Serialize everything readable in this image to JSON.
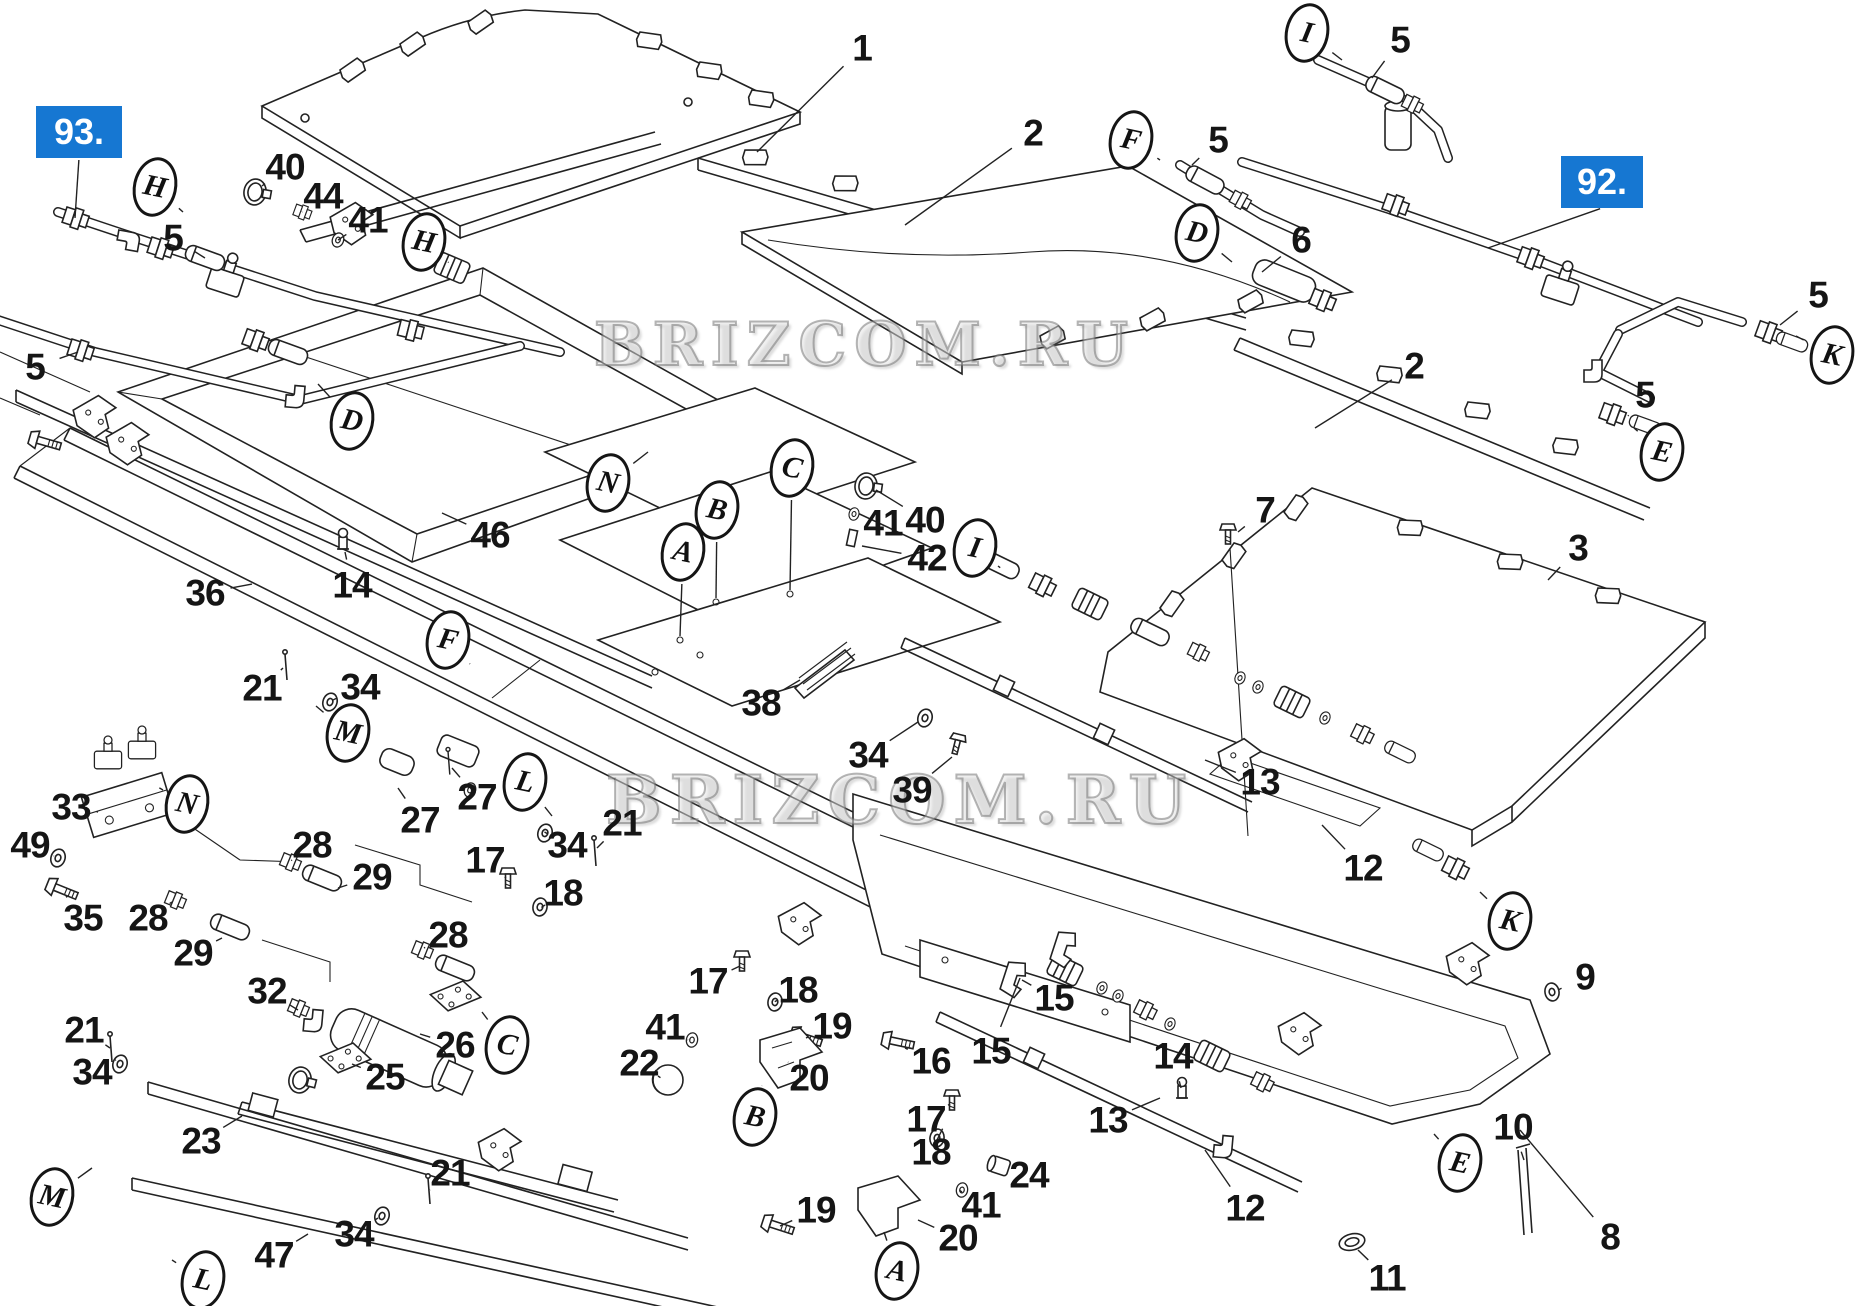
{
  "accent_color": "#1677d2",
  "watermark": {
    "text": "BRIZCOM.RU"
  },
  "watermarks": [
    {
      "x": 865,
      "y": 345,
      "size": 60
    },
    {
      "x": 900,
      "y": 800,
      "size": 66
    }
  ],
  "highlight_boxes": [
    {
      "label": "93.",
      "x": 36,
      "y": 106,
      "w": 86,
      "h": 52,
      "leader": [
        75,
        218
      ]
    },
    {
      "label": "92.",
      "x": 1561,
      "y": 156,
      "w": 82,
      "h": 52,
      "leader": [
        1488,
        248
      ]
    }
  ],
  "callouts": {
    "numbers": [
      {
        "t": "1",
        "x": 862,
        "y": 48,
        "l": [
          757,
          152
        ]
      },
      {
        "t": "2",
        "x": 1033,
        "y": 133,
        "l": [
          905,
          225
        ]
      },
      {
        "t": "2",
        "x": 1414,
        "y": 366,
        "l": [
          1315,
          428
        ]
      },
      {
        "t": "3",
        "x": 1578,
        "y": 548,
        "l": [
          1548,
          580
        ]
      },
      {
        "t": "5",
        "x": 173,
        "y": 238,
        "l": [
          205,
          258
        ]
      },
      {
        "t": "5",
        "x": 35,
        "y": 367,
        "l": [
          78,
          352
        ]
      },
      {
        "t": "5",
        "x": 1218,
        "y": 140,
        "l": [
          1192,
          165
        ]
      },
      {
        "t": "5",
        "x": 1400,
        "y": 40,
        "l": [
          1372,
          78
        ]
      },
      {
        "t": "5",
        "x": 1818,
        "y": 295,
        "l": [
          1780,
          325
        ]
      },
      {
        "t": "5",
        "x": 1645,
        "y": 395,
        "l": [
          1628,
          416
        ]
      },
      {
        "t": "6",
        "x": 1301,
        "y": 240,
        "l": [
          1262,
          272
        ]
      },
      {
        "t": "7",
        "x": 1265,
        "y": 510,
        "l": [
          1238,
          532
        ]
      },
      {
        "t": "8",
        "x": 1610,
        "y": 1237,
        "l": [
          1520,
          1130
        ]
      },
      {
        "t": "9",
        "x": 1585,
        "y": 977,
        "l": [
          1558,
          990
        ]
      },
      {
        "t": "10",
        "x": 1513,
        "y": 1127,
        "l": [
          1524,
          1160
        ]
      },
      {
        "t": "11",
        "x": 1387,
        "y": 1278,
        "l": [
          1358,
          1250
        ]
      },
      {
        "t": "12",
        "x": 1363,
        "y": 868,
        "l": [
          1322,
          825
        ]
      },
      {
        "t": "12",
        "x": 1245,
        "y": 1208,
        "l": [
          1205,
          1150
        ]
      },
      {
        "t": "13",
        "x": 1260,
        "y": 782,
        "l": [
          1205,
          760
        ]
      },
      {
        "t": "13",
        "x": 1108,
        "y": 1120,
        "l": [
          1160,
          1098
        ]
      },
      {
        "t": "14",
        "x": 352,
        "y": 585,
        "l": [
          345,
          552
        ]
      },
      {
        "t": "14",
        "x": 1173,
        "y": 1056,
        "l": [
          1181,
          1088
        ]
      },
      {
        "t": "15",
        "x": 1054,
        "y": 998,
        "l": [
          1022,
          980
        ]
      },
      {
        "t": "15",
        "x": 991,
        "y": 1051,
        "l": [
          1020,
          978
        ]
      },
      {
        "t": "16",
        "x": 931,
        "y": 1061,
        "l": [
          905,
          1048
        ]
      },
      {
        "t": "17",
        "x": 485,
        "y": 860,
        "l": [
          506,
          878
        ]
      },
      {
        "t": "17",
        "x": 708,
        "y": 981,
        "l": [
          740,
          966
        ]
      },
      {
        "t": "17",
        "x": 926,
        "y": 1119,
        "l": [
          950,
          1104
        ]
      },
      {
        "t": "18",
        "x": 563,
        "y": 893,
        "l": [
          545,
          905
        ]
      },
      {
        "t": "18",
        "x": 798,
        "y": 990,
        "l": [
          778,
          1000
        ]
      },
      {
        "t": "18",
        "x": 931,
        "y": 1152,
        "l": [
          937,
          1140
        ]
      },
      {
        "t": "19",
        "x": 832,
        "y": 1026,
        "l": [
          806,
          1038
        ]
      },
      {
        "t": "19",
        "x": 816,
        "y": 1210,
        "l": [
          780,
          1226
        ]
      },
      {
        "t": "20",
        "x": 809,
        "y": 1078,
        "l": [
          788,
          1062
        ]
      },
      {
        "t": "20",
        "x": 958,
        "y": 1238,
        "l": [
          918,
          1220
        ]
      },
      {
        "t": "21",
        "x": 262,
        "y": 688,
        "l": [
          283,
          668
        ]
      },
      {
        "t": "21",
        "x": 622,
        "y": 823,
        "l": [
          597,
          848
        ]
      },
      {
        "t": "21",
        "x": 84,
        "y": 1030,
        "l": [
          110,
          1048
        ]
      },
      {
        "t": "21",
        "x": 450,
        "y": 1173,
        "l": [
          430,
          1190
        ]
      },
      {
        "t": "22",
        "x": 639,
        "y": 1063,
        "l": [
          658,
          1076
        ]
      },
      {
        "t": "23",
        "x": 201,
        "y": 1141,
        "l": [
          242,
          1116
        ]
      },
      {
        "t": "24",
        "x": 1029,
        "y": 1175,
        "l": [
          1004,
          1168
        ]
      },
      {
        "t": "25",
        "x": 385,
        "y": 1077,
        "l": [
          352,
          1064
        ]
      },
      {
        "t": "26",
        "x": 455,
        "y": 1045,
        "l": [
          420,
          1034
        ]
      },
      {
        "t": "27",
        "x": 420,
        "y": 820,
        "l": [
          398,
          788
        ]
      },
      {
        "t": "27",
        "x": 477,
        "y": 797,
        "l": [
          452,
          768
        ]
      },
      {
        "t": "28",
        "x": 312,
        "y": 845,
        "l": [
          292,
          860
        ]
      },
      {
        "t": "28",
        "x": 148,
        "y": 918,
        "l": [
          172,
          902
        ]
      },
      {
        "t": "28",
        "x": 448,
        "y": 935,
        "l": [
          424,
          948
        ]
      },
      {
        "t": "29",
        "x": 372,
        "y": 877,
        "l": [
          338,
          888
        ]
      },
      {
        "t": "29",
        "x": 193,
        "y": 953,
        "l": [
          222,
          938
        ]
      },
      {
        "t": "32",
        "x": 267,
        "y": 991,
        "l": [
          298,
          1010
        ]
      },
      {
        "t": "33",
        "x": 71,
        "y": 807,
        "l": [
          98,
          812
        ]
      },
      {
        "t": "34",
        "x": 360,
        "y": 687,
        "l": [
          333,
          700
        ]
      },
      {
        "t": "34",
        "x": 567,
        "y": 845,
        "l": [
          548,
          834
        ]
      },
      {
        "t": "34",
        "x": 868,
        "y": 755,
        "l": [
          918,
          722
        ]
      },
      {
        "t": "34",
        "x": 92,
        "y": 1072,
        "l": [
          116,
          1060
        ]
      },
      {
        "t": "34",
        "x": 354,
        "y": 1234,
        "l": [
          378,
          1218
        ]
      },
      {
        "t": "35",
        "x": 83,
        "y": 918,
        "l": [
          66,
          896
        ]
      },
      {
        "t": "36",
        "x": 205,
        "y": 593,
        "l": [
          252,
          584
        ]
      },
      {
        "t": "38",
        "x": 761,
        "y": 703,
        "l": [
          800,
          680
        ]
      },
      {
        "t": "39",
        "x": 912,
        "y": 790,
        "l": [
          952,
          757
        ]
      },
      {
        "t": "40",
        "x": 285,
        "y": 167,
        "l": [
          262,
          186
        ]
      },
      {
        "t": "40",
        "x": 925,
        "y": 520,
        "l": [
          876,
          490
        ]
      },
      {
        "t": "41",
        "x": 368,
        "y": 220,
        "l": [
          338,
          240
        ]
      },
      {
        "t": "41",
        "x": 883,
        "y": 523,
        "l": [
          858,
          516
        ]
      },
      {
        "t": "41",
        "x": 665,
        "y": 1027,
        "l": [
          688,
          1040
        ]
      },
      {
        "t": "41",
        "x": 981,
        "y": 1205,
        "l": [
          962,
          1192
        ]
      },
      {
        "t": "42",
        "x": 927,
        "y": 558,
        "l": [
          862,
          546
        ]
      },
      {
        "t": "44",
        "x": 323,
        "y": 196,
        "l": [
          302,
          212
        ]
      },
      {
        "t": "46",
        "x": 490,
        "y": 535,
        "l": [
          442,
          513
        ]
      },
      {
        "t": "47",
        "x": 274,
        "y": 1255,
        "l": [
          308,
          1234
        ]
      },
      {
        "t": "49",
        "x": 30,
        "y": 845,
        "l": [
          54,
          856
        ]
      }
    ],
    "letters": [
      {
        "t": "H",
        "x": 155,
        "y": 187,
        "l": [
          183,
          212
        ]
      },
      {
        "t": "H",
        "x": 424,
        "y": 242,
        "l": [
          448,
          262
        ]
      },
      {
        "t": "D",
        "x": 352,
        "y": 421,
        "l": [
          318,
          384
        ]
      },
      {
        "t": "D",
        "x": 1197,
        "y": 233,
        "l": [
          1232,
          262
        ]
      },
      {
        "t": "F",
        "x": 448,
        "y": 640,
        "l": [
          470,
          664
        ]
      },
      {
        "t": "F",
        "x": 1131,
        "y": 140,
        "l": [
          1160,
          160
        ]
      },
      {
        "t": "I",
        "x": 1307,
        "y": 33,
        "l": [
          1342,
          60
        ]
      },
      {
        "t": "I",
        "x": 975,
        "y": 548,
        "l": [
          998,
          566
        ]
      },
      {
        "t": "N",
        "x": 608,
        "y": 483,
        "l": [
          648,
          452
        ]
      },
      {
        "t": "N",
        "x": 187,
        "y": 804,
        "l": [
          163,
          790
        ]
      },
      {
        "t": "A",
        "x": 683,
        "y": 552,
        "l": [
          680,
          636
        ]
      },
      {
        "t": "A",
        "x": 897,
        "y": 1271,
        "l": [
          884,
          1232
        ]
      },
      {
        "t": "B",
        "x": 717,
        "y": 510,
        "l": [
          716,
          598
        ]
      },
      {
        "t": "B",
        "x": 755,
        "y": 1117,
        "l": [
          762,
          1086
        ]
      },
      {
        "t": "C",
        "x": 792,
        "y": 468,
        "l": [
          790,
          590
        ]
      },
      {
        "t": "C",
        "x": 507,
        "y": 1045,
        "l": [
          482,
          1012
        ]
      },
      {
        "t": "M",
        "x": 348,
        "y": 733,
        "l": [
          316,
          706
        ]
      },
      {
        "t": "M",
        "x": 52,
        "y": 1197,
        "l": [
          92,
          1168
        ]
      },
      {
        "t": "L",
        "x": 525,
        "y": 782,
        "l": [
          552,
          816
        ]
      },
      {
        "t": "L",
        "x": 203,
        "y": 1280,
        "l": [
          172,
          1260
        ]
      },
      {
        "t": "K",
        "x": 1832,
        "y": 355,
        "l": [
          1796,
          336
        ]
      },
      {
        "t": "K",
        "x": 1510,
        "y": 921,
        "l": [
          1480,
          892
        ]
      },
      {
        "t": "E",
        "x": 1662,
        "y": 452,
        "l": [
          1634,
          428
        ]
      },
      {
        "t": "E",
        "x": 1460,
        "y": 1163,
        "l": [
          1434,
          1134
        ]
      }
    ]
  }
}
